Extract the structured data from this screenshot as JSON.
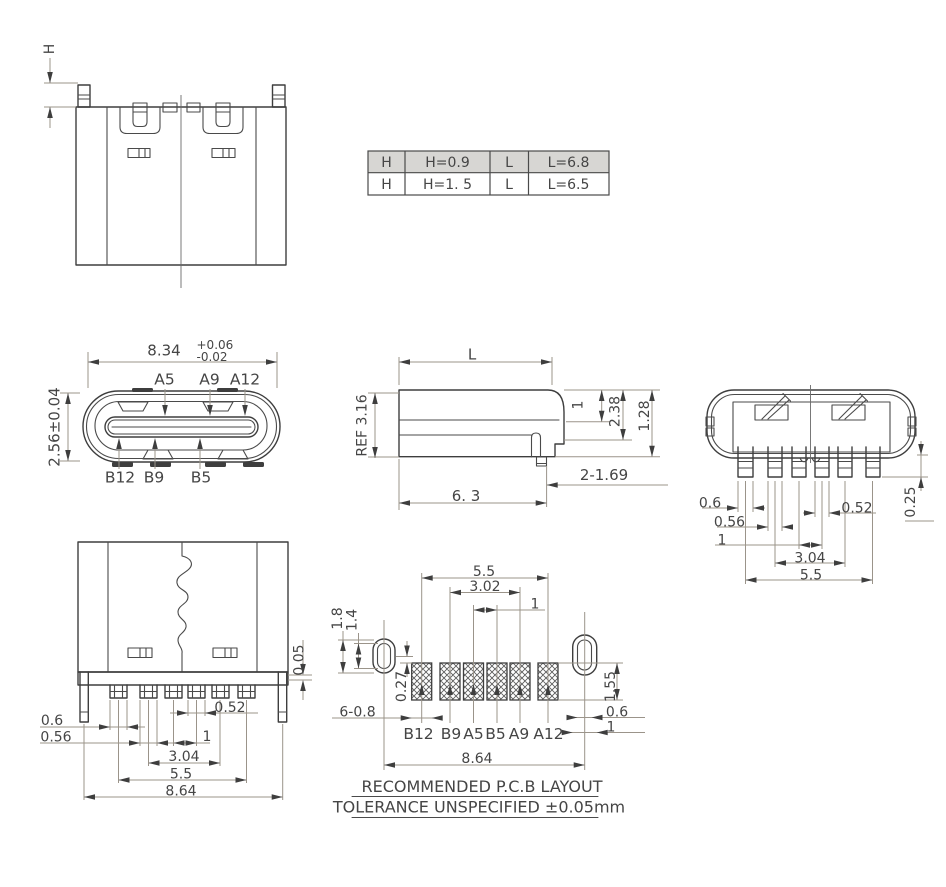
{
  "colors": {
    "outline": "#3e3e3e",
    "dim_line": "#9b948a",
    "text": "#454545",
    "table_header_bg": "#d7d6d3",
    "background": "#ffffff"
  },
  "table": {
    "rows": [
      [
        "H",
        "H=0.9",
        "L",
        "L=6.8"
      ],
      [
        "H",
        "H=1. 5",
        "L",
        "L=6.5"
      ]
    ]
  },
  "front_section_view": {
    "h_label": "H"
  },
  "face_view": {
    "width": "8.34",
    "tol_plus": "+0.06",
    "tol_minus": "-0.02",
    "height": "2.56±0.04",
    "a5": "A5",
    "a9": "A9",
    "a12": "A12",
    "b12": "B12",
    "b9": "B9",
    "b5": "B5"
  },
  "side_view": {
    "l_label": "L",
    "ref": "REF 3.16",
    "d1": "1",
    "d238": "2.38",
    "d128": "1.28",
    "pins": "2-1.69",
    "bottom": "6. 3"
  },
  "rear_view": {
    "d06": "0.6",
    "d056": "0.56",
    "d1": "1",
    "d304": "3.04",
    "d55": "5.5",
    "d052": "0.52",
    "d025": "0.25"
  },
  "back_view": {
    "d005": "0.05",
    "d052": "0.52",
    "d06": "0.6",
    "d056": "0.56",
    "d1": "1",
    "d304": "3.04",
    "d55": "5.5",
    "d864": "8.64"
  },
  "pcb_view": {
    "d55": "5.5",
    "d302": "3.02",
    "d1top": "1",
    "d18": "1.8",
    "d14": "1.4",
    "d027": "0.27",
    "d608": "6-0.8",
    "d155": "1.55",
    "d06": "0.6",
    "d1right": "1",
    "d864": "8.64",
    "pads": [
      "B12",
      "B9",
      "A5",
      "B5",
      "A9",
      "A12"
    ],
    "note1": "RECOMMENDED  P.C.B LAYOUT",
    "note2": "TOLERANCE UNSPECIFIED ±0.05mm"
  }
}
